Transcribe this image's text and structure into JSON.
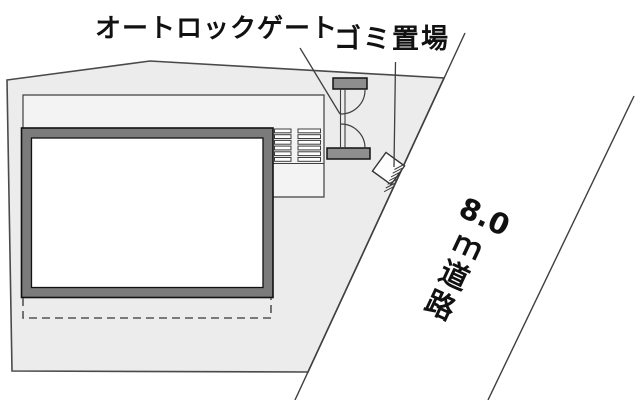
{
  "diagram": {
    "type": "site-plan",
    "labels": {
      "autolock_gate": "オートロックゲート",
      "garbage_area": "ゴミ置場"
    },
    "road": {
      "label_full": "8.0ｍ道路",
      "width_m": "8.0",
      "lines": [
        "8.0",
        "ｍ",
        "道",
        "路"
      ]
    },
    "colors": {
      "background": "#ffffff",
      "site_fill": "#ececed",
      "inner_yard_fill": "#f3f3f4",
      "outline": "#4a4a4a",
      "thin_line": "#3f3f3f",
      "building_frame_fill": "#7b7b7b",
      "building_inner_fill": "#ffffff",
      "gate_bar_fill": "#8e8e8e",
      "garbage_box_fill": "#fdfdfd",
      "text": "#111111"
    }
  }
}
